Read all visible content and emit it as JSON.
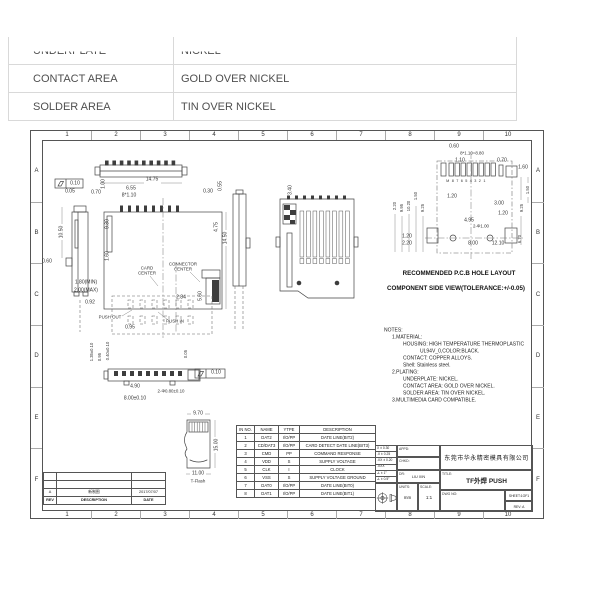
{
  "top_table": {
    "rows": [
      {
        "label": "UNDERPLATE",
        "value": "NICKEL"
      },
      {
        "label": "CONTACT AREA",
        "value": "GOLD OVER NICKEL"
      },
      {
        "label": "SOLDER AREA",
        "value": "TIN OVER NICKEL"
      }
    ]
  },
  "sheet": {
    "zones": {
      "columns": [
        "1",
        "2",
        "3",
        "4",
        "5",
        "6",
        "7",
        "8",
        "9",
        "10"
      ],
      "rows": [
        "A",
        "B",
        "C",
        "D",
        "E",
        "F"
      ]
    },
    "labels": [
      {
        "t": "0.10",
        "x": 75,
        "y": 184
      },
      {
        "t": "0.05",
        "x": 70,
        "y": 192
      },
      {
        "t": "0.70",
        "x": 96,
        "y": 193
      },
      {
        "t": "1.00",
        "x": 104,
        "y": 184,
        "cls": "v"
      },
      {
        "t": "14.75",
        "x": 152,
        "y": 180
      },
      {
        "t": "6.55",
        "x": 131,
        "y": 189
      },
      {
        "t": "8*1.10",
        "x": 129,
        "y": 196
      },
      {
        "t": "0.30",
        "x": 208,
        "y": 192
      },
      {
        "t": "0.55",
        "x": 221,
        "y": 186,
        "cls": "v"
      },
      {
        "t": "10.50",
        "x": 62,
        "y": 232,
        "cls": "v"
      },
      {
        "t": "0.60",
        "x": 47,
        "y": 262
      },
      {
        "t": "9.30",
        "x": 108,
        "y": 224,
        "cls": "v"
      },
      {
        "t": "1.60",
        "x": 108,
        "y": 256,
        "cls": "v"
      },
      {
        "t": "4.75",
        "x": 217,
        "y": 227,
        "cls": "v"
      },
      {
        "t": "14.50",
        "x": 226,
        "y": 238,
        "cls": "v"
      },
      {
        "t": "CARD\nCENTER",
        "x": 147,
        "y": 271,
        "cls": "sm"
      },
      {
        "t": "CONNECTOR\nCENTER",
        "x": 183,
        "y": 267,
        "cls": "sm"
      },
      {
        "t": "1.80(MIN)",
        "x": 86,
        "y": 283
      },
      {
        "t": "2.00(MAX)",
        "x": 86,
        "y": 291
      },
      {
        "t": "0.92",
        "x": 90,
        "y": 303
      },
      {
        "t": "2.84",
        "x": 181,
        "y": 298
      },
      {
        "t": "5.60",
        "x": 201,
        "y": 296,
        "cls": "v"
      },
      {
        "t": "PUSH OUT",
        "x": 110,
        "y": 318,
        "cls": "sm"
      },
      {
        "t": "PUSH IN",
        "x": 175,
        "y": 322,
        "cls": "sm"
      },
      {
        "t": "0.95",
        "x": 130,
        "y": 328
      },
      {
        "t": "3.40",
        "x": 291,
        "y": 190,
        "cls": "v"
      },
      {
        "t": "1.35±0.10",
        "x": 92,
        "y": 352,
        "cls": "v sm"
      },
      {
        "t": "0.95",
        "x": 100,
        "y": 357,
        "cls": "v sm"
      },
      {
        "t": "0.40±0.10",
        "x": 108,
        "y": 351,
        "cls": "v sm"
      },
      {
        "t": "0.05",
        "x": 186,
        "y": 354,
        "cls": "v sm"
      },
      {
        "t": "0.10",
        "x": 216,
        "y": 373
      },
      {
        "t": "4.90",
        "x": 135,
        "y": 387
      },
      {
        "t": "2-Φ0.80±0.10",
        "x": 171,
        "y": 392,
        "cls": "sm"
      },
      {
        "t": "8.00±0.10",
        "x": 135,
        "y": 399
      },
      {
        "t": "9.70",
        "x": 198,
        "y": 414
      },
      {
        "t": "15.00",
        "x": 217,
        "y": 445,
        "cls": "v"
      },
      {
        "t": "11.00",
        "x": 198,
        "y": 474
      },
      {
        "t": "T-Flash",
        "x": 198,
        "y": 482,
        "cls": "sm"
      },
      {
        "t": "0.60",
        "x": 454,
        "y": 147
      },
      {
        "t": "8*1.10=8.80",
        "x": 472,
        "y": 154,
        "cls": "sm"
      },
      {
        "t": "1.10",
        "x": 460,
        "y": 161
      },
      {
        "t": "0.70",
        "x": 502,
        "y": 161
      },
      {
        "t": "1.60",
        "x": 523,
        "y": 168
      },
      {
        "t": "M87654321",
        "x": 467,
        "y": 181,
        "cls": "pads"
      },
      {
        "t": "1.20",
        "x": 452,
        "y": 197
      },
      {
        "t": "2.20",
        "x": 395,
        "y": 206,
        "cls": "v sm"
      },
      {
        "t": "9.95",
        "x": 402,
        "y": 208,
        "cls": "v sm"
      },
      {
        "t": "10.20",
        "x": 409,
        "y": 206,
        "cls": "v sm"
      },
      {
        "t": "1.50",
        "x": 416,
        "y": 196,
        "cls": "v sm"
      },
      {
        "t": "9.25",
        "x": 423,
        "y": 208,
        "cls": "v sm"
      },
      {
        "t": "3.00",
        "x": 499,
        "y": 204
      },
      {
        "t": "1.20",
        "x": 503,
        "y": 214
      },
      {
        "t": "4.95",
        "x": 469,
        "y": 221
      },
      {
        "t": "2-Φ1.00",
        "x": 481,
        "y": 227,
        "cls": "sm"
      },
      {
        "t": "1.20",
        "x": 407,
        "y": 237
      },
      {
        "t": "2.20",
        "x": 407,
        "y": 244
      },
      {
        "t": "8.00",
        "x": 473,
        "y": 244
      },
      {
        "t": "12.10",
        "x": 498,
        "y": 244
      },
      {
        "t": "1.50",
        "x": 528,
        "y": 190,
        "cls": "v sm"
      },
      {
        "t": "9.25",
        "x": 522,
        "y": 208,
        "cls": "v sm"
      },
      {
        "t": "6.70",
        "x": 520,
        "y": 239,
        "cls": "v sm"
      },
      {
        "t": "RECOMMENDED P.C.B HOLE LAYOUT",
        "x": 459,
        "y": 274,
        "cls": "cap"
      },
      {
        "t": "COMPONENT SIDE VIEW(TOLERANCE:+/-0.05)",
        "x": 456,
        "y": 289,
        "cls": "cap"
      },
      {
        "t": "NOTES:",
        "x": 384,
        "y": 331,
        "cls": "note"
      },
      {
        "t": "1.MATERIAL:",
        "x": 392,
        "y": 338,
        "cls": "note"
      },
      {
        "t": "HOUSING: HIGH TEMPERATURE THERMOPLASTIC",
        "x": 403,
        "y": 345,
        "cls": "note"
      },
      {
        "t": "UL94V_0,COLOR:BLACK.",
        "x": 420,
        "y": 352,
        "cls": "note"
      },
      {
        "t": "CONTACT: COPPER ALLOYS.",
        "x": 403,
        "y": 359,
        "cls": "note"
      },
      {
        "t": "Shell: Stainless steel.",
        "x": 403,
        "y": 366,
        "cls": "note"
      },
      {
        "t": "2.PLATING:",
        "x": 392,
        "y": 373,
        "cls": "note"
      },
      {
        "t": "UNDERPLATE: NICKEL.",
        "x": 403,
        "y": 380,
        "cls": "note"
      },
      {
        "t": "CONTACT AREA: GOLD OVER NICKEL.",
        "x": 403,
        "y": 387,
        "cls": "note"
      },
      {
        "t": "SOLDER AREA: TIN OVER NICKEL.",
        "x": 403,
        "y": 394,
        "cls": "note"
      },
      {
        "t": "3.MULTIMEDIA CARD COMPATIBLE.",
        "x": 392,
        "y": 401,
        "cls": "note"
      }
    ],
    "pin_table": {
      "headers": [
        "IN NO.",
        "NAME",
        "YTPE",
        "DESCRIPTION"
      ],
      "rows": [
        [
          "1",
          "DAT2",
          "I/O/PP",
          "DATE LINE(BIT2)"
        ],
        [
          "2",
          "CD/DAT3",
          "I/O/PP",
          "CARD DETECT DATE LINE(BIT3)"
        ],
        [
          "3",
          "CMD",
          "PP",
          "COMMAND RESPONSE"
        ],
        [
          "4",
          "VDD",
          "S",
          "SUPPLY VOLTAGE"
        ],
        [
          "5",
          "CLK",
          "I",
          "CLOCK"
        ],
        [
          "6",
          "VSS",
          "S",
          "SUPPLY VOLTAGE GROUND"
        ],
        [
          "7",
          "DAT0",
          "I/O/PP",
          "DATE LINE(BIT0)"
        ],
        [
          "8",
          "DAT1",
          "I/O/PP",
          "DATE LINE(BIT1)"
        ]
      ]
    },
    "title_block": {
      "tolerances": [
        "X ± 0.30",
        ".X ± 0.25",
        ".XX ± 0.20",
        ".XXX",
        "∠ ± 1°",
        "∠ ± 0.5°"
      ],
      "appd_label": "APPD:",
      "chkd_label": "CHKD:",
      "dr_label": "DR:",
      "dr_value": "LIU XIN",
      "units_label": "UNITS:",
      "units_value": "mm",
      "scale_label": "SCALE:",
      "scale_value": "1:1",
      "company": "东莞市华永精密模具有限公司",
      "title_label": "TITLE:",
      "title": "TF外焊 PUSH",
      "dwg_label": "DWG NO:",
      "sheet_text": "SHEET:1OF1",
      "rev_text": "REV: A"
    },
    "revision_table": {
      "rows": [
        [
          "",
          "",
          ""
        ],
        [
          "",
          "",
          ""
        ],
        [
          "A",
          "新制图",
          "2017/07/07"
        ],
        [
          "REV",
          "DESCRIPTION",
          "DATE"
        ]
      ]
    }
  },
  "colors": {
    "line": "#444444",
    "frame": "#555555",
    "table_border": "#d9d9d9",
    "text": "#222222"
  }
}
